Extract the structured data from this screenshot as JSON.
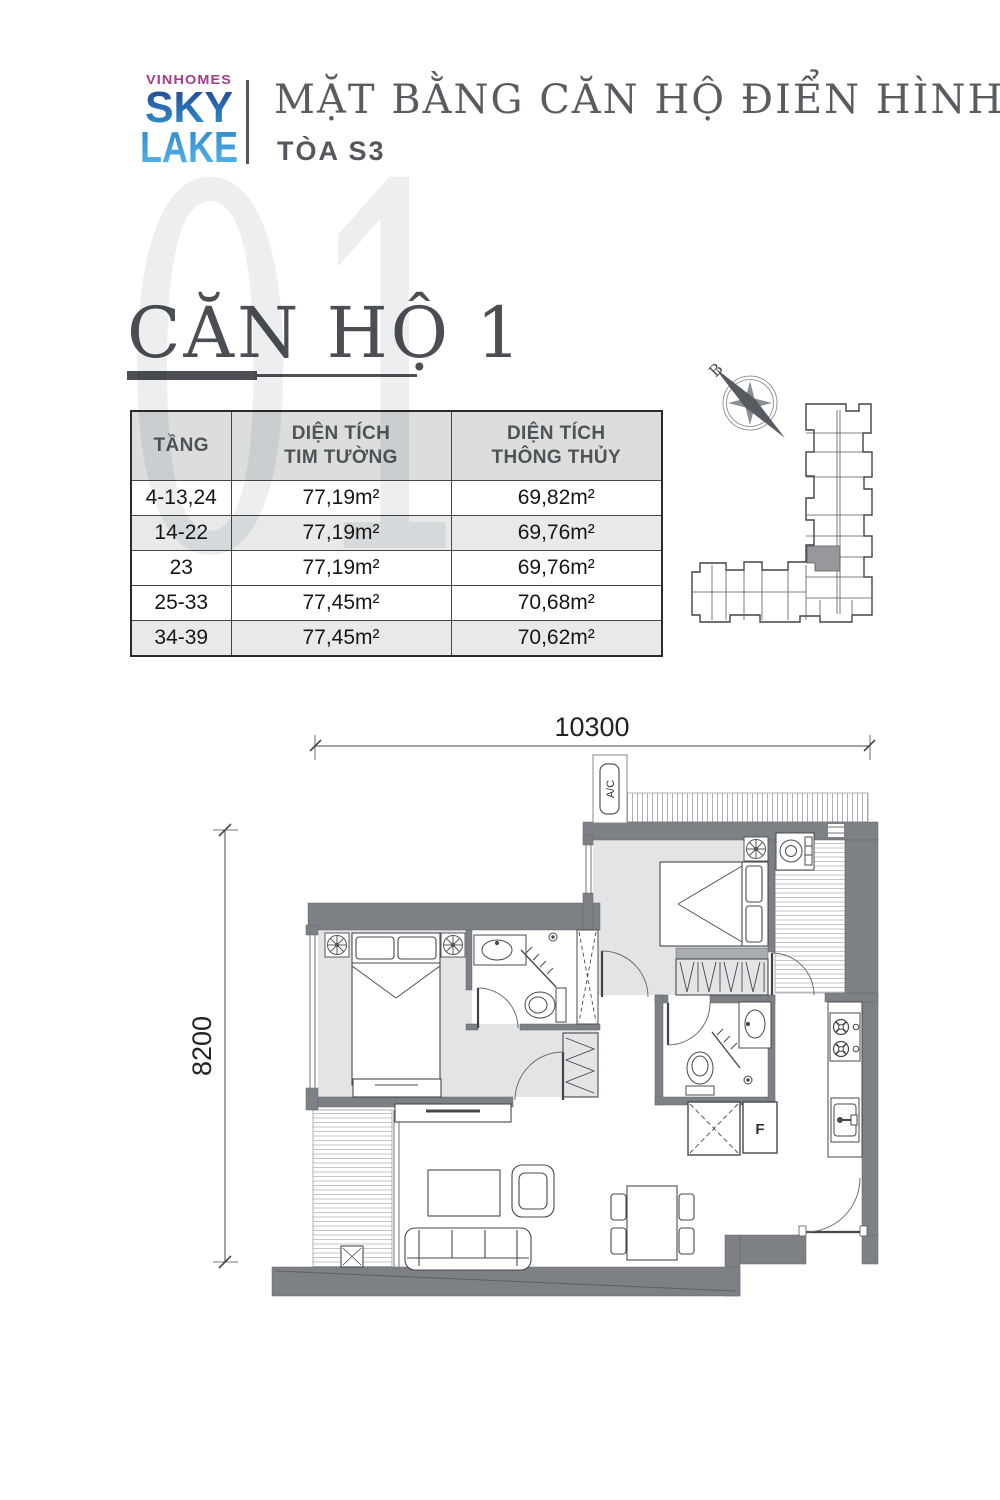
{
  "brand": {
    "name": "VINHOMES",
    "logo_line1": "SKY",
    "logo_line2": "LAKE",
    "magenta": "#a83a8c",
    "blue_top": "#24408f",
    "blue_bottom": "#2f9ad6",
    "blue_lake_top": "#2f86c8",
    "blue_lake_bottom": "#58b8ea"
  },
  "header": {
    "title": "MẶT BẰNG CĂN HỘ ĐIỂN HÌNH",
    "subtitle": "TÒA S3"
  },
  "section": {
    "watermark": "01",
    "title": "CĂN HỘ 1"
  },
  "area_table": {
    "col_floor": "TẦNG",
    "col_area1_line1": "DIỆN TÍCH",
    "col_area1_line2": "TIM TƯỜNG",
    "col_area2_line1": "DIỆN TÍCH",
    "col_area2_line2": "THÔNG THỦY",
    "rows": [
      {
        "floor": "4-13,24",
        "gross": "77,19m²",
        "net": "69,82m²"
      },
      {
        "floor": "14-22",
        "gross": "77,19m²",
        "net": "69,76m²"
      },
      {
        "floor": "23",
        "gross": "77,19m²",
        "net": "69,76m²"
      },
      {
        "floor": "25-33",
        "gross": "77,45m²",
        "net": "70,68m²"
      },
      {
        "floor": "34-39",
        "gross": "77,45m²",
        "net": "70,62m²"
      }
    ]
  },
  "plan": {
    "dim_width": "10300",
    "dim_height": "8200",
    "ac_label": "A/C",
    "f_label": "F",
    "compass_label": "B",
    "wall_color": "#7d8185",
    "floor_color": "#e3e4e6",
    "highlight_unit_color": "#96989c"
  }
}
